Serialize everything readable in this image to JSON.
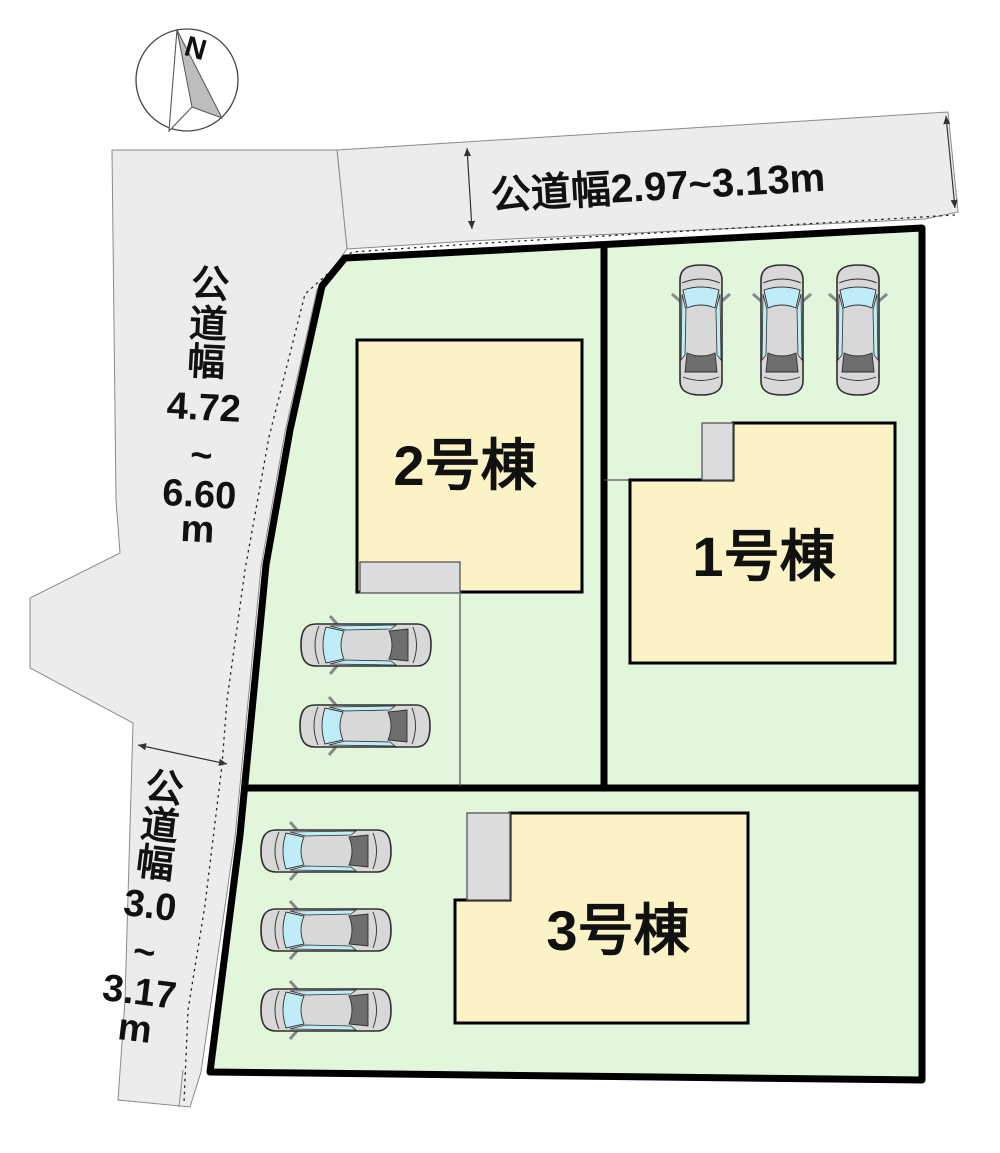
{
  "compass": {
    "north_label": "N"
  },
  "roads": {
    "top": {
      "label": "公道幅2.97~3.13m"
    },
    "west": {
      "lines": [
        "公",
        "道",
        "幅",
        "4.72",
        "~",
        "6.60",
        "m"
      ]
    },
    "southwest": {
      "lines": [
        "公",
        "道",
        "幅",
        "3.0",
        "~",
        "3.17",
        "m"
      ]
    }
  },
  "parcels": {
    "building1": {
      "label": "1号棟"
    },
    "building2": {
      "label": "2号棟"
    },
    "building3": {
      "label": "3号棟"
    }
  },
  "colors": {
    "road_gray": "#ECECEC",
    "lot_green": "#E1F6DA",
    "building_yellow": "#FBF2C6",
    "porch_gray": "#DCDCDE",
    "car_body_gray": "#D8D8D8",
    "car_window_cyan": "#BEEDF8",
    "car_rear_gray": "#6E6E6E",
    "boundary_black": "#000000"
  }
}
